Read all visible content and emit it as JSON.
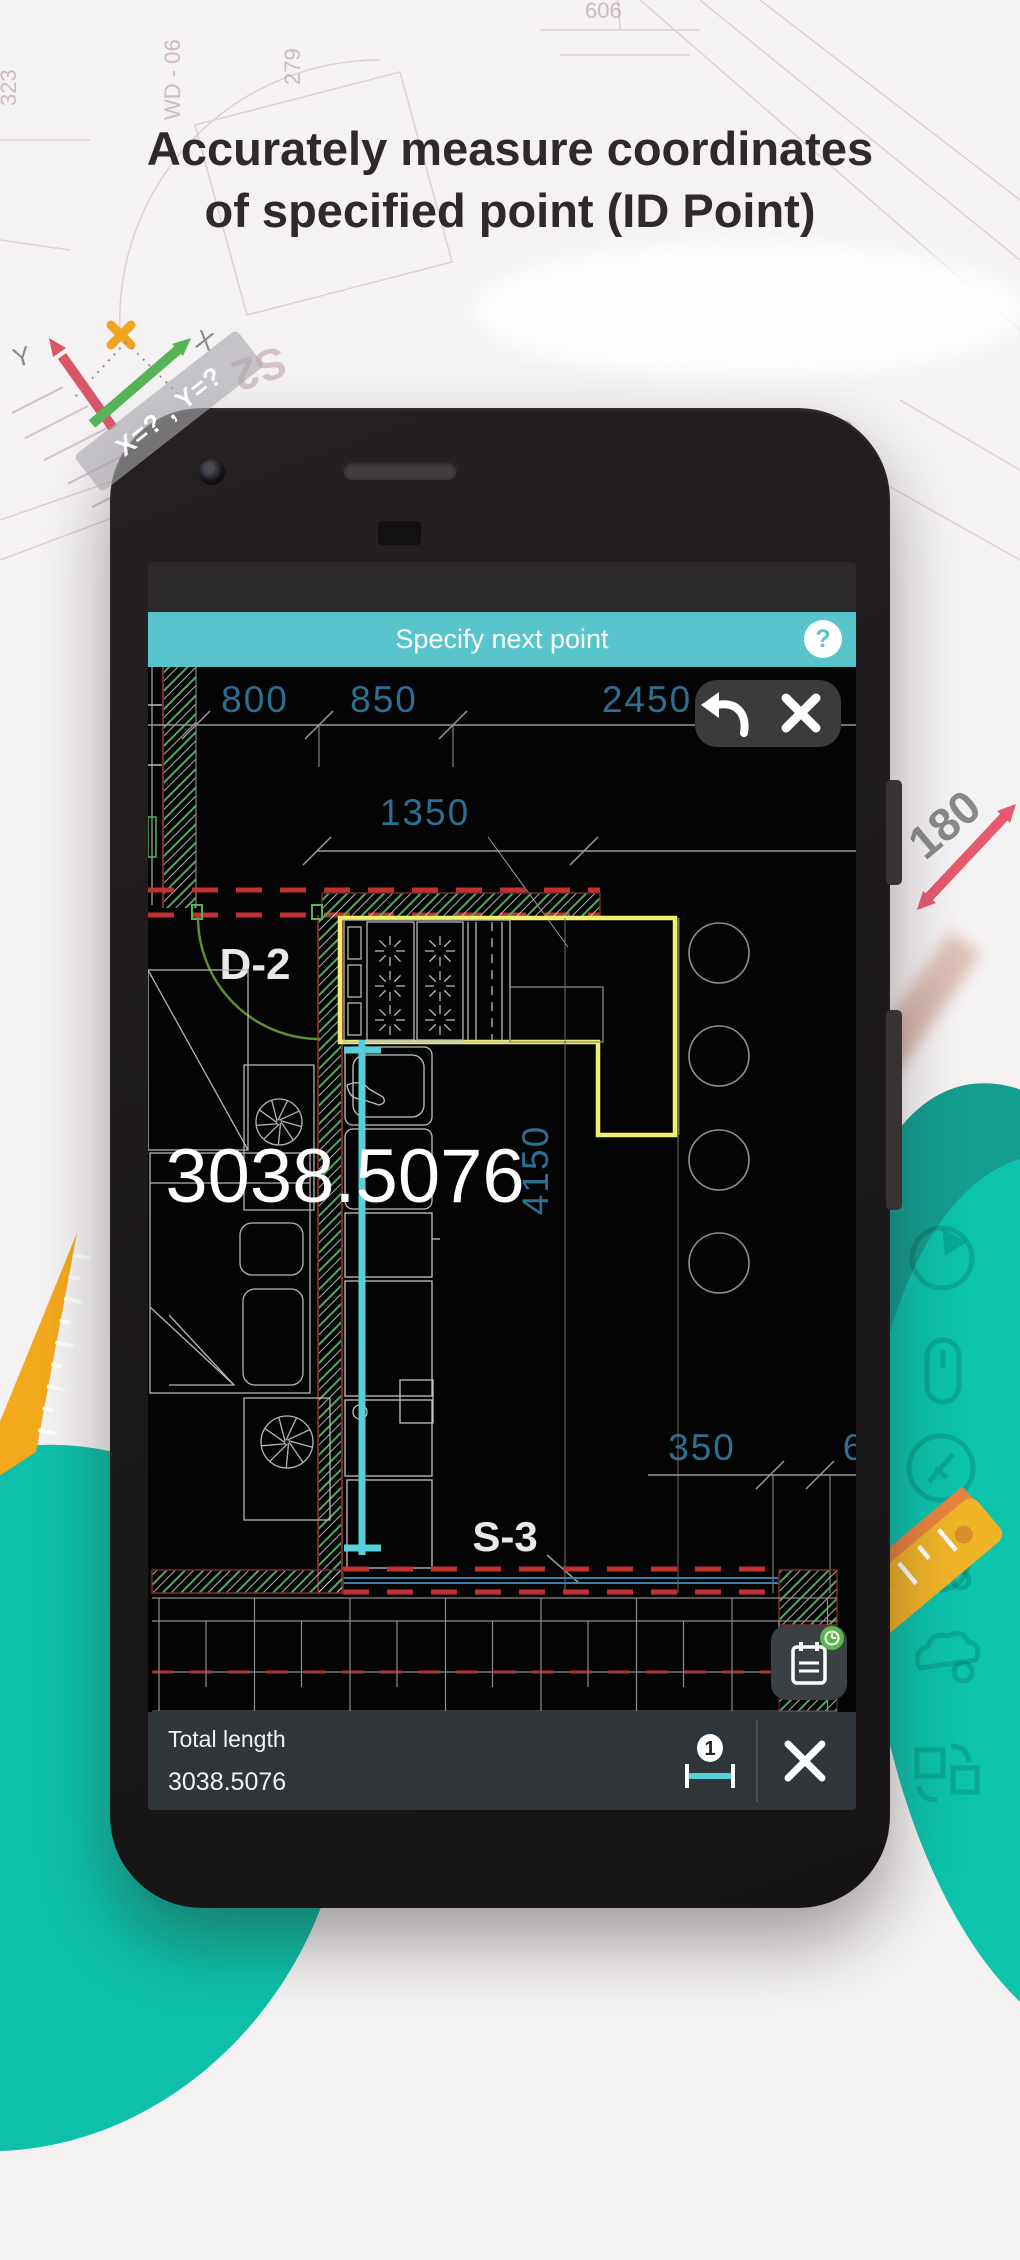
{
  "headline": {
    "line1": "Accurately measure coordinates",
    "line2": "of specified point (ID Point)"
  },
  "decor": {
    "axis_band": "X=? , Y=?",
    "axis_x": "X",
    "axis_y": "Y",
    "angle": "180",
    "s2": "S2",
    "n606": "606",
    "n279": "279",
    "n323": "323",
    "n40": "40",
    "wd06": "WD - 06"
  },
  "screen": {
    "header": {
      "title": "Specify next point",
      "help": "?"
    },
    "cad": {
      "d800": "800",
      "d850": "850",
      "d2450": "2450",
      "d1350": "1350",
      "d4150": "4150",
      "d350": "350",
      "d_partial": "6",
      "door_label": "D-2",
      "section_label": "S-3",
      "measurement": "3038.5076"
    },
    "bottom": {
      "label": "Total length",
      "value": "3038.5076",
      "badge": "1"
    }
  },
  "colors": {
    "accent_teal": "#57c5cb",
    "blob_teal": "#0cc3ac",
    "dim_blue": "#2d6e93",
    "measure_cyan": "#55cfda",
    "counter_yellow": "#eef06e",
    "hatch_green": "#4fa863",
    "warn_red": "#c23030",
    "amber": "#f3a91c",
    "arrow_red": "#d95666",
    "arrow_green": "#57b357"
  }
}
